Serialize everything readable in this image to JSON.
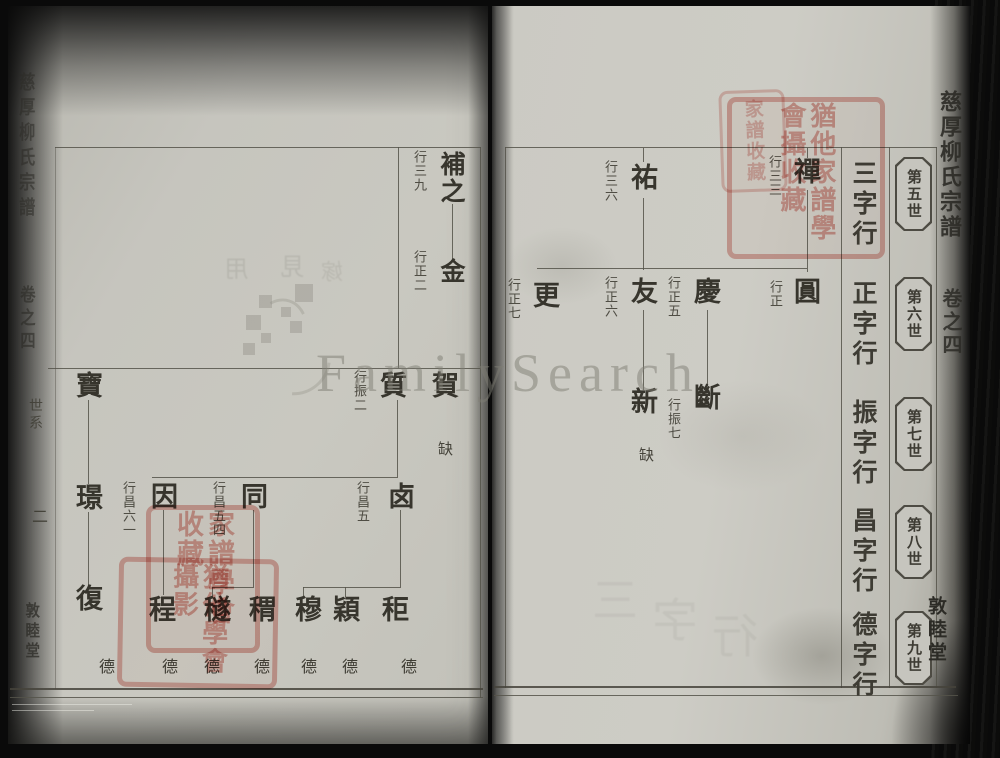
{
  "book": {
    "spine_title": "慈厚柳氏宗譜",
    "volume_label": "卷之四",
    "section_label": "世系",
    "page_number": "二",
    "hall_name": "敦睦堂"
  },
  "watermark": {
    "brand_text": "FamilySearch"
  },
  "generations": [
    {
      "rank": "第五世",
      "row_name": "三字行"
    },
    {
      "rank": "第六世",
      "row_name": "正字行"
    },
    {
      "rank": "第七世",
      "row_name": "振字行"
    },
    {
      "rank": "第八世",
      "row_name": "昌字行"
    },
    {
      "rank": "第九世",
      "row_name": "德字行"
    }
  ],
  "right_page": {
    "persons": {
      "chan": {
        "name": "禪",
        "note": "行三三"
      },
      "you": {
        "name": "祐",
        "note": "行三六"
      },
      "yuan": {
        "name": "圓",
        "note": "行正"
      },
      "qing": {
        "name": "慶",
        "note": "行正五"
      },
      "you2": {
        "name": "友",
        "note": "行正六"
      },
      "geng": {
        "name": "更",
        "note": "行正七"
      },
      "duan": {
        "name": "斷",
        "note": "行振七"
      },
      "xin": {
        "name": "新"
      },
      "que": {
        "text": "缺"
      }
    }
  },
  "left_page": {
    "persons": {
      "buzhi": {
        "name": "補之",
        "note": "行三九"
      },
      "jin": {
        "name": "金",
        "note": "行正二"
      },
      "bao": {
        "name": "寶"
      },
      "jing": {
        "name": "璟"
      },
      "fu": {
        "name": "復"
      },
      "zhi": {
        "name": "質",
        "note": "行振二"
      },
      "he": {
        "name": "賀"
      },
      "que": {
        "text": "缺"
      },
      "yin": {
        "name": "因",
        "note": "行昌六一"
      },
      "tong": {
        "name": "同",
        "note": "行昌五四"
      },
      "lu": {
        "name": "卤",
        "note": "行昌五"
      },
      "cheng": {
        "name": "程"
      },
      "sui": {
        "name": "穟"
      },
      "chou": {
        "name": "稩"
      },
      "mu": {
        "name": "穆"
      },
      "ying": {
        "name": "穎"
      },
      "ju": {
        "name": "秬"
      }
    },
    "de_row": [
      "德",
      "德",
      "德",
      "德",
      "德",
      "德",
      "德"
    ]
  },
  "seals": {
    "top_overlap": "家譜收藏",
    "top_main": "猶他家譜學會攝收藏",
    "left_main": "家譜學會收藏",
    "left_lower": "猶他學會攝影"
  },
  "ghosts": {
    "left": [
      "用",
      "見",
      "嫁"
    ],
    "right": [
      "三",
      "字",
      "行"
    ]
  }
}
